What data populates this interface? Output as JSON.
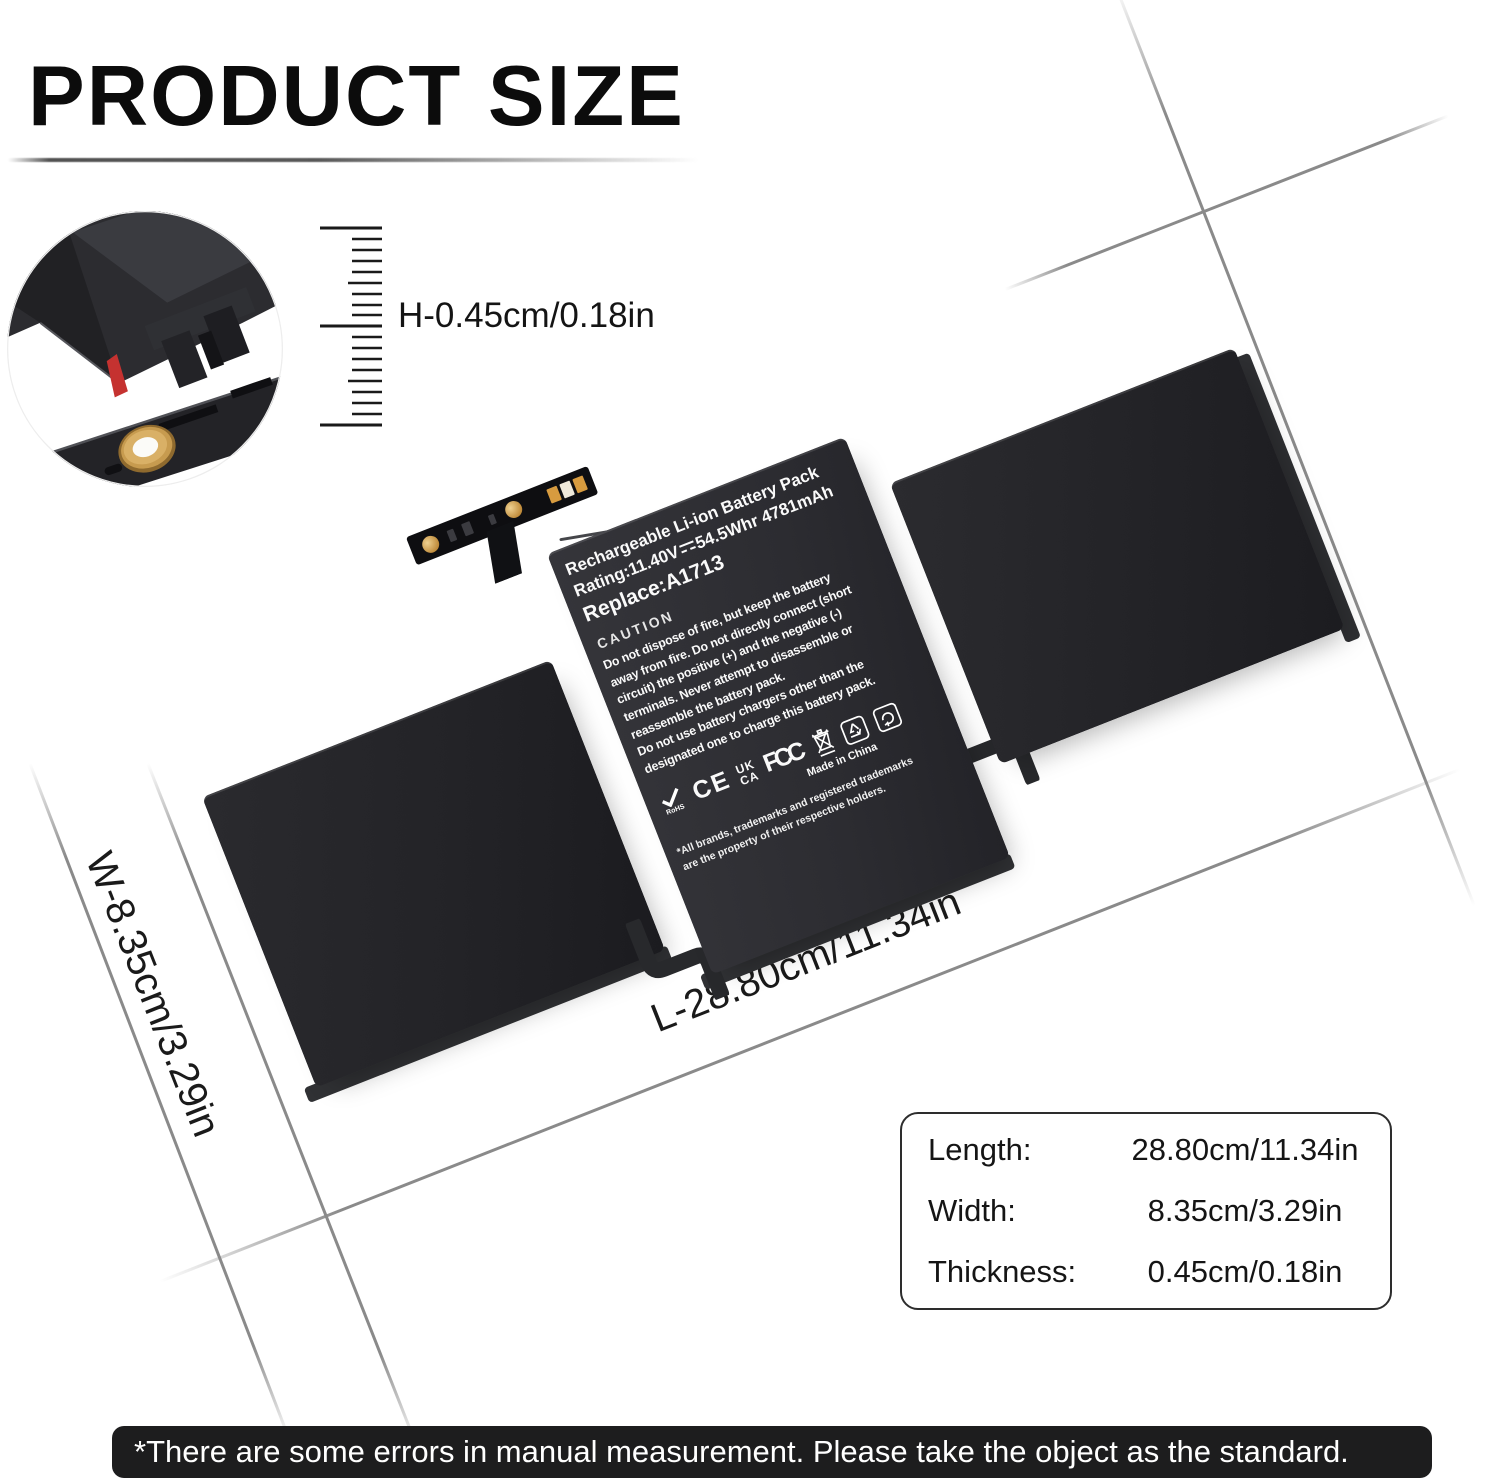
{
  "title": "PRODUCT SIZE",
  "inset": {
    "height_label": "H-0.45cm/0.18in"
  },
  "dimension_labels": {
    "width": "W-8.35cm/3.29in",
    "length": "L-28.80cm/11.34in"
  },
  "battery_label": {
    "line1": "Rechargeable Li-ion Battery Pack",
    "rating_prefix": "Rating:11.40V",
    "rating_suffix": "54.5Whr 4781mAh",
    "replace_line": "Replace:A1713",
    "caution_title": "CAUTION",
    "caution_lines": [
      "Do not dispose of fire, but keep the battery",
      "away from fire. Do not directly connect (short",
      "circuit) the positive (+) and the negative (-)",
      "terminals. Never attempt to disassemble or",
      "reassemble the battery pack.",
      "Do not use battery chargers other than the",
      "designated one to charge this battery pack."
    ],
    "rohs_text": "RoHS",
    "ce_text": "CE",
    "ukca_line1": "UK",
    "ukca_line2": "CA",
    "fcc_text": "FCC",
    "made_in": "Made in China",
    "trademark_note_line1": "*All brands, trademarks and registered trademarks",
    "trademark_note_line2": "are the property of their respective holders."
  },
  "size_table": {
    "rows": [
      {
        "label": "Length:",
        "value": "28.80cm/11.34in"
      },
      {
        "label": "Width:",
        "value": "8.35cm/3.29in"
      },
      {
        "label": "Thickness:",
        "value": "0.45cm/0.18in"
      }
    ]
  },
  "disclaimer": "*There are some errors in manual measurement. Please take the object as the standard.",
  "colors": {
    "background": "#ffffff",
    "battery_dark": "#232327",
    "battery_face": "#2c2c31",
    "label_text": "#fafafa",
    "dim_line": "#8a8a8a",
    "red_accent": "#c53230",
    "grommet_gold": "#c79b4f",
    "disclaimer_bg": "#1d1d1e",
    "table_border": "#2d2d2d"
  }
}
